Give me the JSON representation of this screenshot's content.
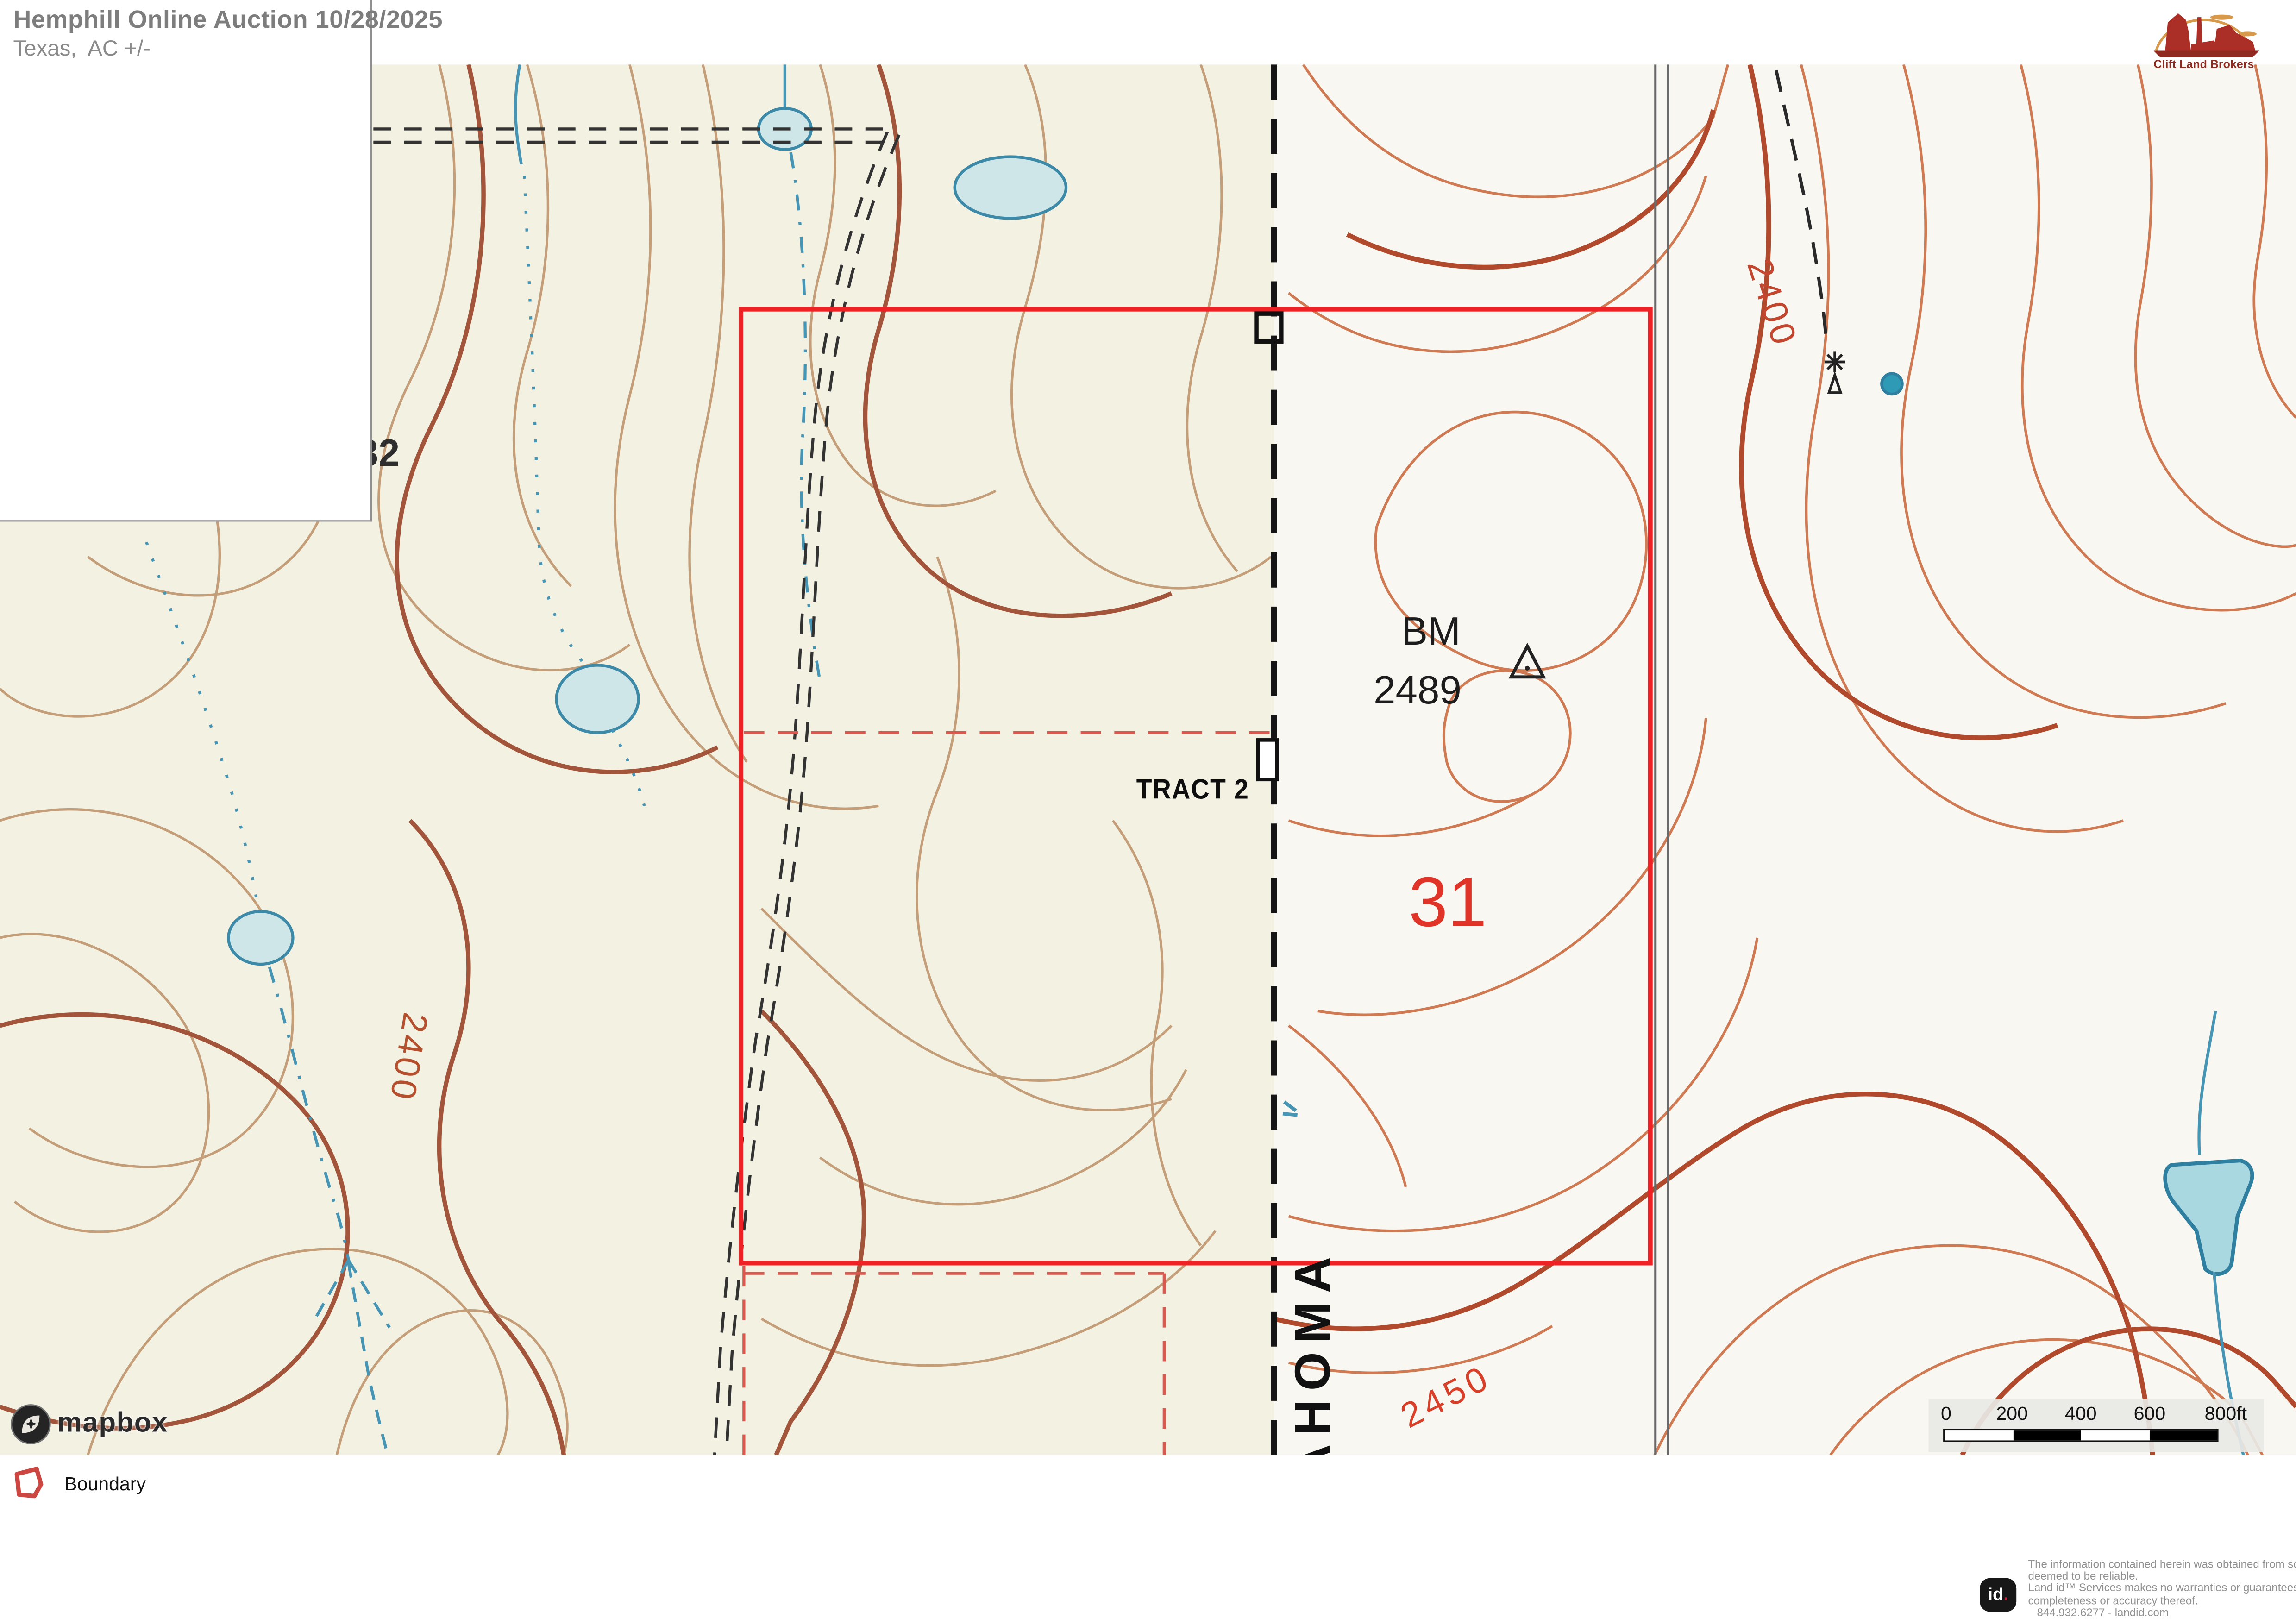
{
  "header": {
    "title": "Hemphill Online Auction 10/28/2025",
    "subtitle": "Texas,  AC +/-"
  },
  "broker": {
    "name": "Clift Land Brokers"
  },
  "map": {
    "labels": {
      "tract": "TRACT 2",
      "section_right": "31",
      "section_left": "32",
      "benchmark_prefix": "BM",
      "benchmark_elevation": "2489",
      "state_name": "OKLAHOMA",
      "contour_2400_right": "2400",
      "contour_2400_left": "2400",
      "contour_2450": "2450"
    },
    "colors": {
      "boundary_red": "#ee2125",
      "survey_dash_red": "#d65a50",
      "contour_light_left": "#c49e79",
      "contour_index_left": "#a2553a",
      "contour_light_right": "#cf7a52",
      "contour_index_right": "#b14a2c",
      "water_blue": "#4795b5",
      "pond_fill": "#c3e2e6",
      "bg_left": "#f3f1e2",
      "bg_right": "#f8f7f2"
    }
  },
  "scale_bar": {
    "ticks": [
      "0",
      "200",
      "400",
      "600",
      "800ft"
    ]
  },
  "attribution": {
    "mapbox": "mapbox"
  },
  "legend": {
    "boundary_label": "Boundary",
    "boundary_color": "#cd4742"
  },
  "disclaimer": {
    "logo_text": "id",
    "lines": [
      "The information contained herein was obtained from sources",
      "deemed to be reliable.",
      "Land id™ Services makes no warranties or guarantees as to the",
      "completeness or accuracy thereof.",
      "844.932.6277 - landid.com"
    ]
  }
}
